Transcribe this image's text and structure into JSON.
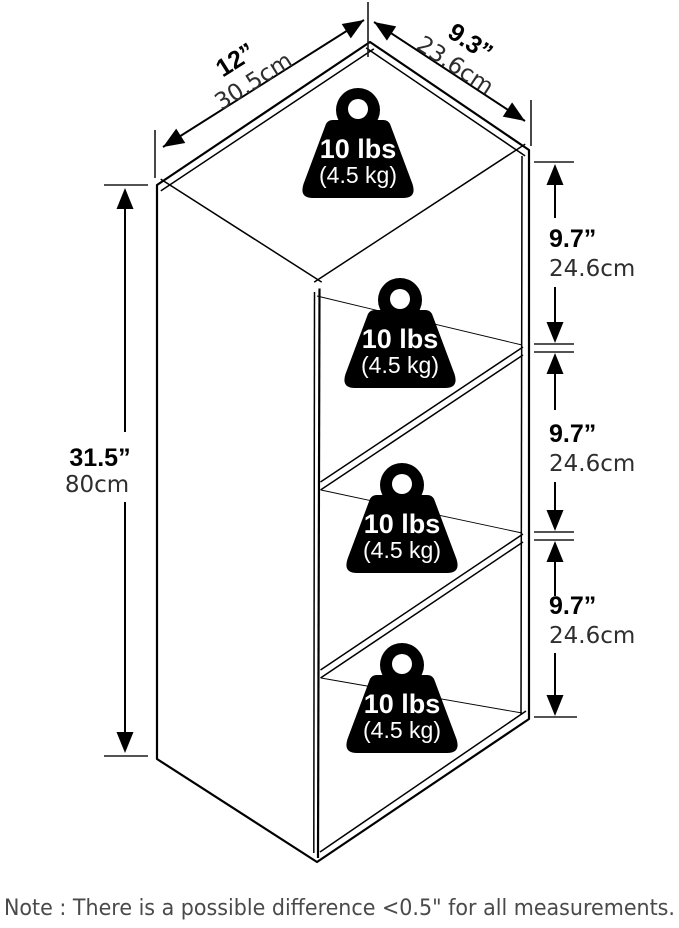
{
  "colors": {
    "ink": "#000000",
    "background": "#ffffff",
    "note_text": "#4a4a4a"
  },
  "dimensions": {
    "width": {
      "inch": "12”",
      "cm": "30.5cm"
    },
    "depth": {
      "inch": "9.3”",
      "cm": "23.6cm"
    },
    "height": {
      "inch": "31.5”",
      "cm": "80cm"
    },
    "sections": [
      {
        "inch": "9.7”",
        "cm": "24.6cm"
      },
      {
        "inch": "9.7”",
        "cm": "24.6cm"
      },
      {
        "inch": "9.7”",
        "cm": "24.6cm"
      }
    ]
  },
  "weights": [
    {
      "lbs": "10 lbs",
      "kg": "(4.5 kg)"
    },
    {
      "lbs": "10 lbs",
      "kg": "(4.5 kg)"
    },
    {
      "lbs": "10 lbs",
      "kg": "(4.5 kg)"
    },
    {
      "lbs": "10 lbs",
      "kg": "(4.5 kg)"
    }
  ],
  "note": "Note : There is a possible difference <0.5\" for all measurements."
}
